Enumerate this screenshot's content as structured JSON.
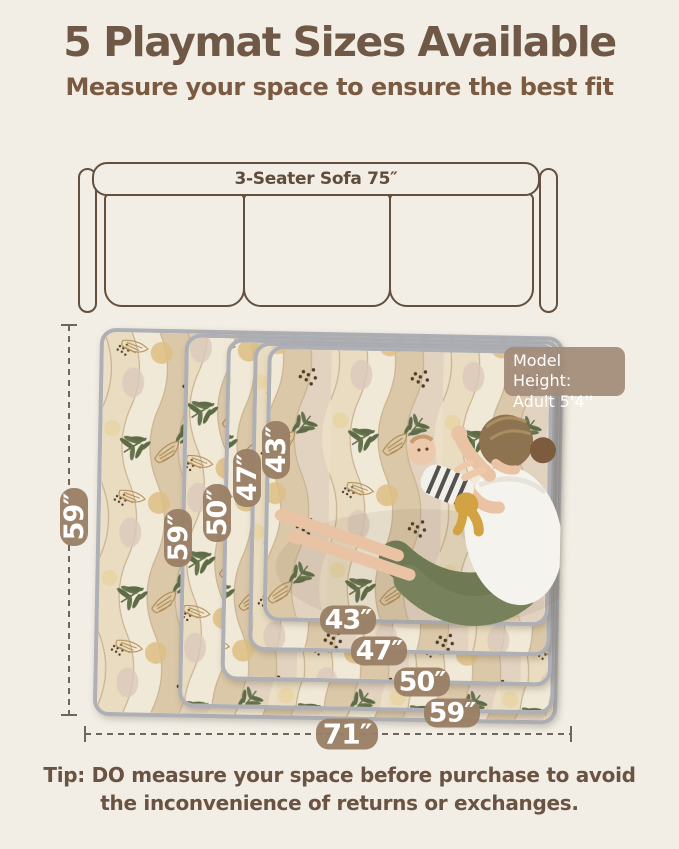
{
  "header": {
    "title": "5 Playmat Sizes Available",
    "subtitle": "Measure your space to ensure the best fit"
  },
  "sofa": {
    "label": "3-Seater Sofa 75″"
  },
  "diagram": {
    "overall": {
      "height_label": "59″",
      "width_label": "71″"
    },
    "mats": [
      {
        "height_label": "59″",
        "width_label": "59″"
      },
      {
        "height_label": "50″",
        "width_label": "50″"
      },
      {
        "height_label": "47″",
        "width_label": "47″"
      },
      {
        "height_label": "43″",
        "width_label": "43″"
      }
    ],
    "model_note": {
      "line1": "Model Height:",
      "line2": "Adult  5'4''"
    }
  },
  "footer": {
    "tip_line1": "Tip: DO measure your space before purchase to avoid",
    "tip_line2": "the inconvenience of returns or exchanges."
  },
  "colors": {
    "background": "#f2eee5",
    "title_text": "#6f5845",
    "subtitle_text": "#7a5a41",
    "outline_brown": "#63503f",
    "badge_bg": "#997f65",
    "badge_text": "#ffffff",
    "note_bg": "#a38c7a",
    "mat_binding_gray": "#aeb0b6",
    "mat_base": "#efe6d2",
    "leaf_green": "#5d6b47",
    "leaf_tan": "#b08a50",
    "pants_olive": "#6f7a55",
    "dash_line": "#6e665c"
  }
}
